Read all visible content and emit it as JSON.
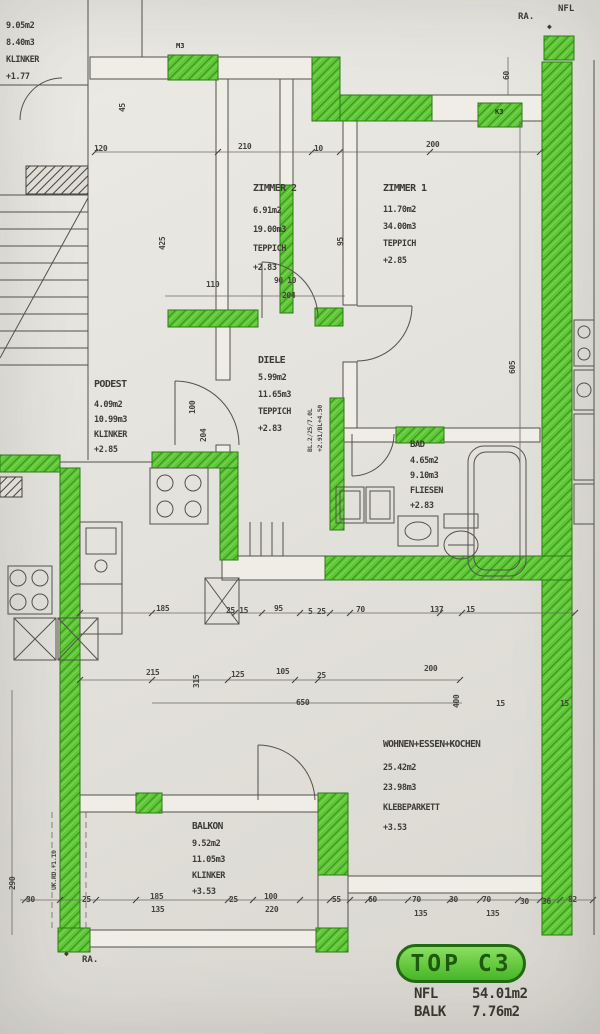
{
  "sheet": {
    "ra_top": "RA.",
    "nfl_top": "NFL",
    "ra_bottom": "RA.",
    "diamond": "◆"
  },
  "rooms": {
    "zimmer2": {
      "name": "ZIMMER 2",
      "area": "6.91m2",
      "volume": "19.00m3",
      "floor": "TEPPICH",
      "level": "+2.83"
    },
    "zimmer1": {
      "name": "ZIMMER 1",
      "area": "11.70m2",
      "volume": "34.00m3",
      "floor": "TEPPICH",
      "level": "+2.85"
    },
    "diele": {
      "name": "DIELE",
      "area": "5.99m2",
      "volume": "11.65m3",
      "floor": "TEPPICH",
      "level": "+2.83"
    },
    "bad": {
      "name": "BAD",
      "area": "4.65m2",
      "volume": "9.10m3",
      "floor": "FLIESEN",
      "level": "+2.83"
    },
    "podest": {
      "name": "PODEST",
      "area": "4.09m2",
      "volume": "10.99m3",
      "floor": "KLINKER",
      "level": "+2.85"
    },
    "wohnen": {
      "name": "WOHNEN+ESSEN+KOCHEN",
      "area": "25.42m2",
      "volume": "23.98m3",
      "floor": "KLEBEPARKETT",
      "level": "+3.53"
    },
    "balkon": {
      "name": "BALKON",
      "area": "9.52m2",
      "volume": "11.05m3",
      "floor": "KLINKER",
      "level": "+3.53"
    },
    "neighbor": {
      "area": "9.05m2",
      "volume": "8.40m3",
      "floor": "KLINKER",
      "level": "+1.77"
    }
  },
  "title_block": {
    "unit": "TOP C3",
    "rows": [
      {
        "label": "NFL",
        "value": "54.01m2"
      },
      {
        "label": "BALK",
        "value": "7.76m2"
      }
    ]
  },
  "wall_tags": {
    "m3": "M3",
    "k3": "K3"
  },
  "annotations": {
    "uk_rd": "UK.RD.+1.10",
    "bl1": "BL.2/25/7.0L",
    "bl2": "+2.91/BL+4.50"
  },
  "dims": [
    "120",
    "210",
    "10",
    "200",
    "60",
    "425",
    "95",
    "110",
    "90 10",
    "204",
    "100",
    "204",
    "45",
    "605",
    "185",
    "25 15",
    "95",
    "5 25",
    "70",
    "137",
    "15",
    "215",
    "315",
    "125",
    "105",
    "25",
    "200",
    "650",
    "400",
    "15",
    "15",
    "290",
    "30",
    "25",
    "185",
    "135",
    "25",
    "100",
    "220",
    "55",
    "60",
    "70",
    "135",
    "30",
    "70",
    "135",
    "30",
    "36",
    "82"
  ],
  "colors": {
    "highlight": "#5fc637",
    "line": "#52514b",
    "paper": "#e4e2dc"
  }
}
